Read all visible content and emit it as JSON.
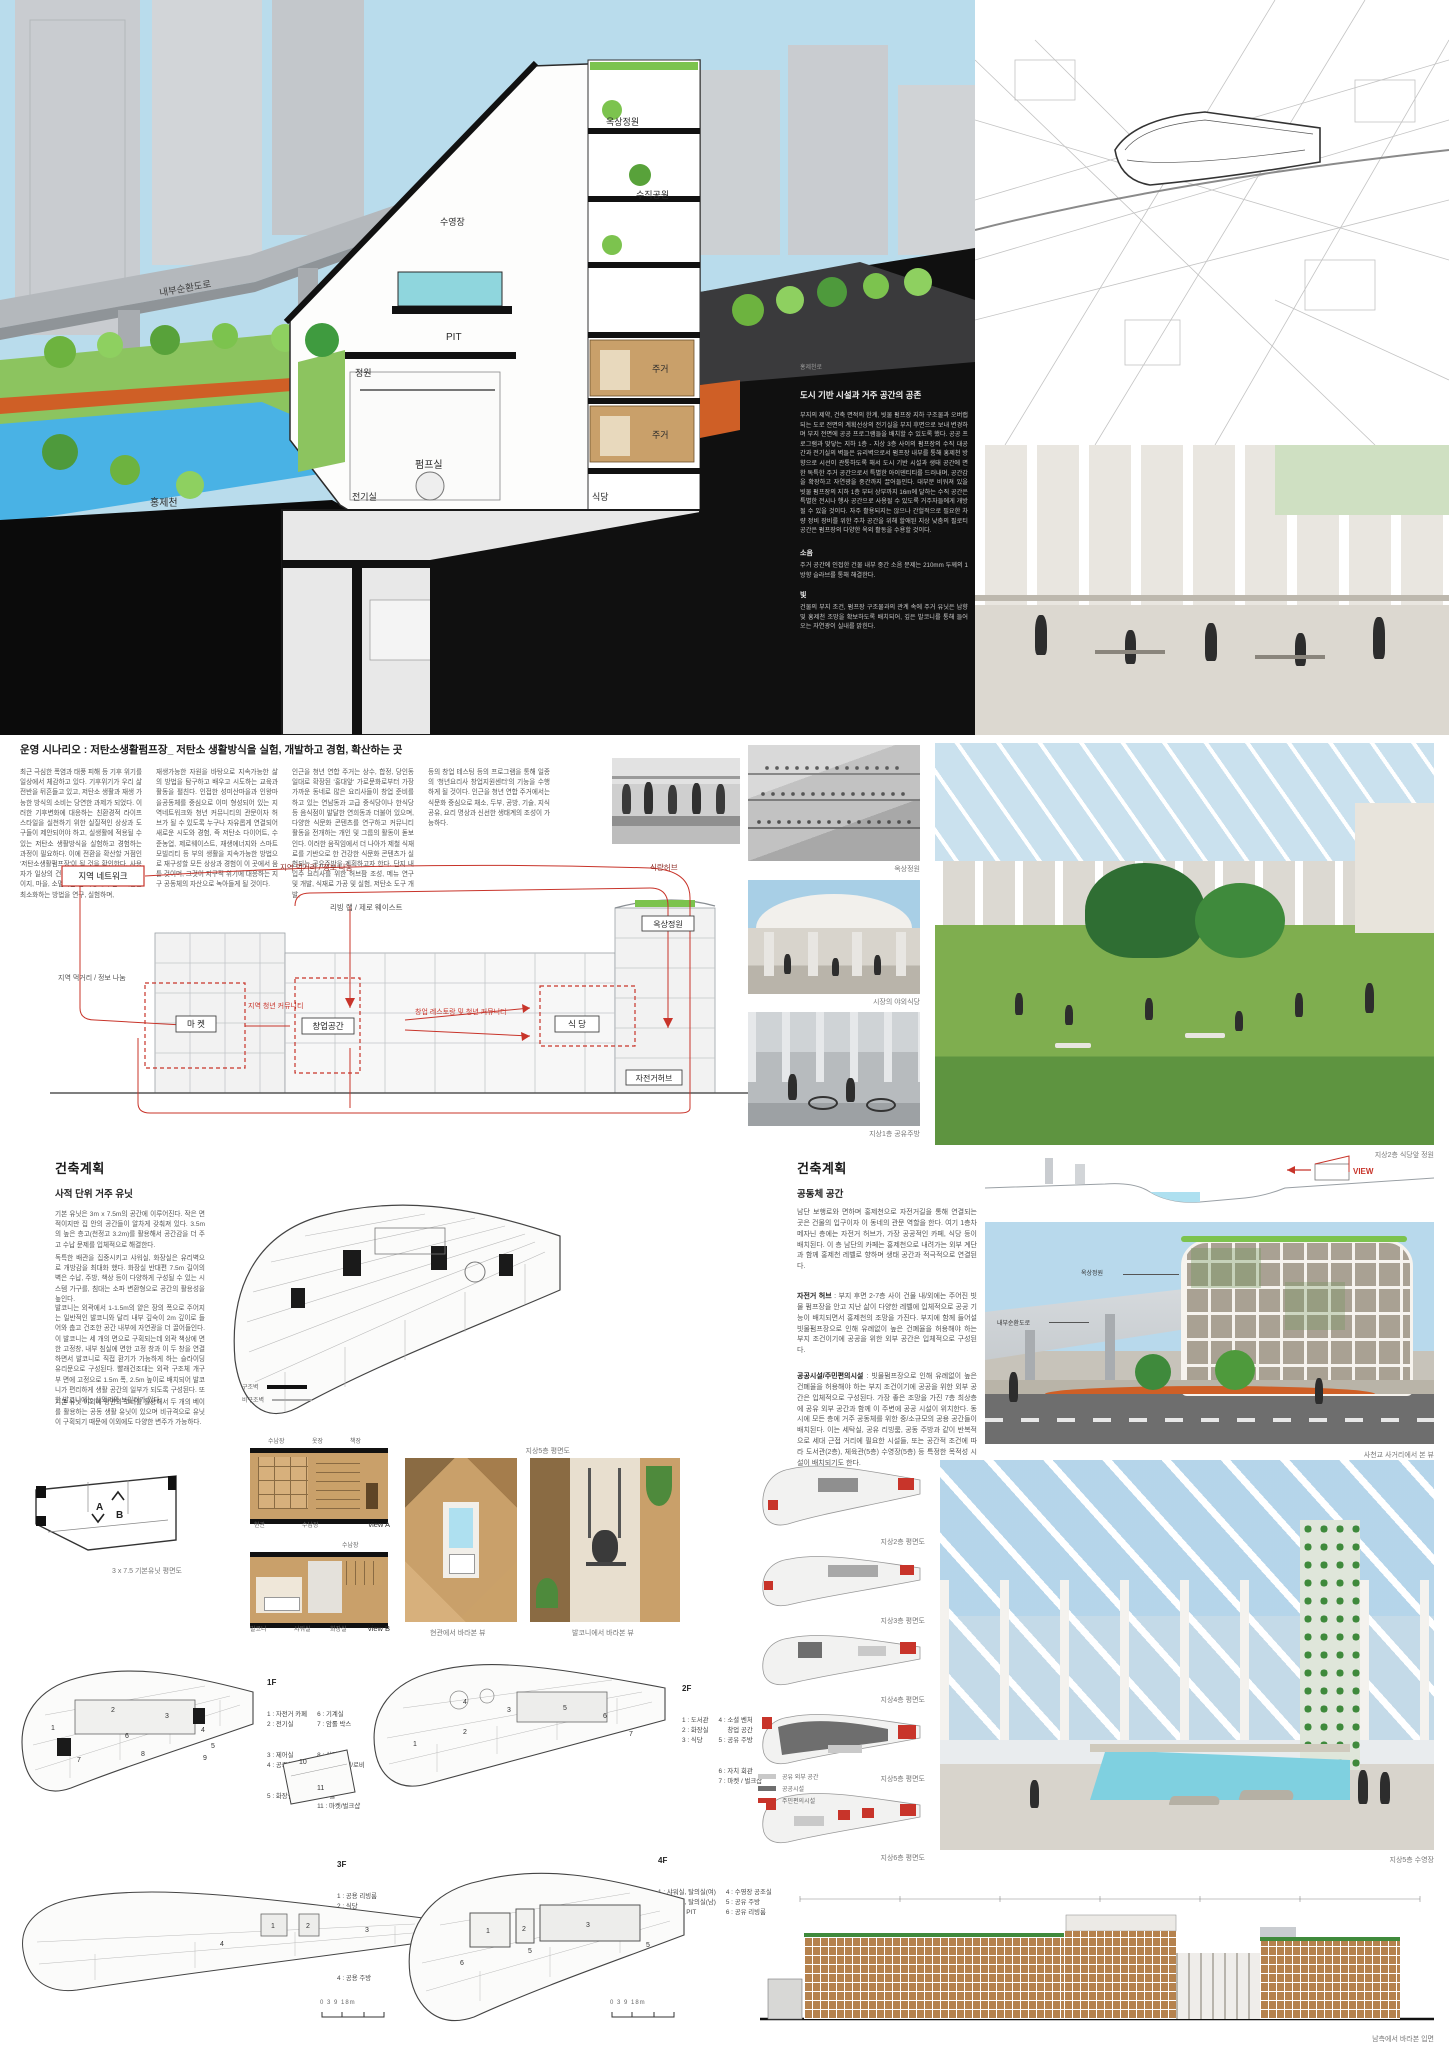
{
  "section": {
    "labels": {
      "road": "내부순환도로",
      "stream": "홍제천",
      "pool": "수영장",
      "roof_garden": "옥상정원",
      "vertical_park": "수직공원",
      "pit": "PIT",
      "garden": "정원",
      "housing_upper": "주거",
      "housing_lower": "주거",
      "pump_room": "펌프실",
      "electrical": "전기실",
      "dining": "식당",
      "street": "홍제천로"
    },
    "side": {
      "heading": "도시 기반 시설과 거주 공간의 공존",
      "body": "부지의 제약, 건축 면적의 한계, 빗물 펌프장 지하 구조물과 오버랩되는 도로 전면의 계획선상의 전기실을 부지 후면으로 보내 변경하며 부지 전면에 공공 프로그램들을 배치할 수 있도록 했다. 공공 프로그램과 맞닿는 지하 1층 - 지상 3층 사이의 펌프장의 수직 대공간과 전기실의 벽들은 유리벽으로서 펌프장 내부를 통해 홍제천 방향으로 시선이 관통하도록 해서 도시 기반 시설과 생태 공간에 면한 독특한 주거 공간으로서 특별한 아이덴티티를 드러내며, 공간감을 확장하고 자연광을 중간까지 끌어들인다. 대부분 비워져 있을 빗물 펌프장의 지하 1층 부터 상부까지 16m에 달하는 수직 공간은 특별한 전시나 행사 공간으로 사용될 수 있도록 거주자들에게 개방될 수 있을 것이다. 자주 활용되지는 않으나 간헐적으로 필요한 차량 정비 장비를 위한 주차 공간을 위해 할애된 지상 낮춤의 필로티 공간은 펌프장의 다양한 옥외 활동을 수용할 것이다.",
      "noise_head": "소음",
      "noise_body": "주거 공간에 인접한 건물 내부 중간 소음 문제는 210mm 두께의 1방향 슬라브를 통해 해결한다.",
      "light_head": "빛",
      "light_body": "건물의 부지 조건, 펌프장 구조물과의 관계 속에 주거 유닛은 남향 및 홍제천 조망을 확보하도록 배치되어, 깊은 발코니를 통해 들어오는 자연광이 실내를 밝힌다."
    }
  },
  "scenario": {
    "title": "운영 시나리오 : 저탄소생활펌프장_ 저탄소 생활방식을 실험, 개발하고 경험, 확산하는 곳",
    "col1": "최근 극심한 폭염과 태풍 피해 등 기후 위기를 일상에서 체감하고 있다. 기후위기가 우리 삶 전반을 뒤흔들고 있고, 저탄소 생활과 재생 가능한 방식의 소비는 당연한 과제가 되었다. 이러한 기후변화에 대응하는 친환경적 라이프스타일을 실천하기 위한 실질적인 상상과 도구들이 제안되어야 하고, 실생활에 적용될 수 있는 저탄소 생활방식을 실험하고 경험하는 과정이 필요하다. 이에 전환을 확산할 거점인 '저탄소생활펌프장'이 될 것을 확인한다. 사용자가 일상의 건물 직접 생산할 수 있고, 스테이지, 마을, 소멸되는 전 과정에서 탄소배출을 최소화하는 방법을 연구, 실험하며,",
    "col2": "재생가능한 자원을 바탕으로 지속가능한 삶의 방법을 탐구하고 배우고 시도하는 교육과 활동을 펼친다. 인접한 성미산마을과 인왕마을공동체를 중심으로 이미 형성되어 있는 지역네트워크와 청년 커뮤니티의 관문이자 허브가 될 수 있도록 누구나 자유롭게 연결되어 새로운 시도와 경험, 즉 저탄소 다이어트, 수준농업, 제로웨이스트, 재생에너지와 스마트 모빌리티 등 부의 생활을 지속가능한 방법으로 재구성할 모든 상상과 경험이 이 곳에서 움틀 것이며, 그것이 지구적 위기에 대응하는 지구 공동체의 자산으로 녹아들게 될 것이다.",
    "col3": "인근을 청년 연합 주거는 상수, 합정, 당인동 일대로 확장된 '홍대앞' 가로문화로부터 가장 가까운 동네로 많은 요리사들이 창업 준비를 하고 있는 연남동과 고급 중식당이나 한식당 등 음식점이 발달한 연희동과 더불어 있으며, 다양한 식문화 콘텐츠를 연구하고 커뮤니티 활동을 전개하는 개인 및 그룹의 활동이 돋보인다. 이러한 움직임에서 더 나아가 제철 식재료를 기반으로 한 건강한 식문화 콘텐츠가 실험되는 공유주방을 계획하고자 한다. 단지 내 입주 요리사를 위한 허브팜 조성, 메뉴 연구 및 개발, 식재료 가공 및 실험, 저탄소 도구 개발,",
    "col4": "등의 창업 테스팅 등의 프로그램을 통해 일종의 '청년요리사 창업지원센터'의 기능을 수행하게 될 것이다. 인근을 청년 연합 주거에서는 식문화 중심으로 채소, 두부, 공방, 기술, 지식 공유, 요리 명상과 신선한 생태계의 조성이 가능하다."
  },
  "flow": {
    "top_label": "지역 먹거리 / 정보 나눔",
    "top_right_label": "식량허브",
    "mid_label": "리빙 랩 / 제로 웨이스트",
    "left_label": "지역 먹거리 / 정보 나눔",
    "network_box": "지역 네트워크",
    "market_box": "마 켓",
    "youth_label": "지역 청년 커뮤니티",
    "startup_box": "창업공간",
    "startup_rest_label": "창업 레스토랑 및\n청년 커뮤니티",
    "dining_box": "식 당",
    "roofgarden_box": "옥상정원",
    "bike_box": "자전거허브"
  },
  "right_photos": {
    "cap1": "옥상정원",
    "cap2": "시장의 야외식당",
    "cap3": "지상1층 공유주방",
    "cap_big": "지상2층 식당앞 정원"
  },
  "arch_left": {
    "heading": "건축계획",
    "subheading": "사적 단위 거주 유닛",
    "p1": "기본 유닛은 3m x 7.5m의 공간에 이루어진다. 작은 면적이지만 집 안의 공간들이 알차게 갖춰져 있다. 3.5m의 높은 층고(천정고 3.2m)를 활용해서 공간감을 더 주고 수납 문제를 입체적으로 해결한다.",
    "p2": "독특한 배관을 집중시키고 샤워실, 화장실은 유리벽으로 개방감을 최대화 했다. 화장실 반대편 7.5m 길이의 벽은 수납, 주방, 책상 등이 다양하게 구성될 수 있는 시스템 가구를, 침대는 소파 변환형으로 공간의 활용성을 높인다.",
    "p3": "발코니는 외곽에서 1-1.5m의 얕은 장의 폭으로 주어지는 일반적인 발코니와 달리 내부 깊숙이 2m 깊이로 들어와 춥고 건조한 공간 내부에 자연광을 더 끌어들인다. 이 발코니는 세 개의 면으로 구획되는데 외곽 책상에 면한 고정창, 내부 침실에 면한 고정 창과 이 두 창을 연결하면서 발코니로 직접 환기가 가능하게 하는 슬라이딩 유리문으로 구성된다. 빨래건조대는 외곽 구조체 개구부 면에 고정으로 1.5m 폭, 2.5m 높이로 배치되어 발코니가 편리하게 생활 공간의 일부가 되도록 구성된다. 또한 발코니에는 실외기와 보일러가 있다.",
    "p4": "기본 유닛 이외에 평면의 코너를 활용해서 두 개의 베이를 활용하는 공동 생활 유닛이 있으며 비규격으로 유닛이 구획되기 때문에 이외에도 다양한 변주가 가능하다.",
    "legend_struct": "구조벽",
    "legend_nonstruct": "비구조벽",
    "plan_caption": "지상5층 평면도"
  },
  "unit_row": {
    "plan_caption": "3 x 7.5 기본유닛 평면도",
    "viewA_top1": "수납장",
    "viewA_top2": "옷장",
    "viewA_top3": "책장",
    "viewA_bot1": "현관",
    "viewA_bot2": "수납장",
    "viewA_label": "view A",
    "viewB_top1": "수납장",
    "viewB_bot1": "발코니",
    "viewB_bot2": "샤워실",
    "viewB_bot3": "화장실",
    "viewB_label": "view B",
    "render1_caption": "현관에서 바라본 뷰",
    "render2_caption": "발코니에서 바라본 뷰",
    "arrowA": "A",
    "arrowB": "B"
  },
  "plans": {
    "f1": {
      "title": "1F",
      "col1": [
        "1 : 자전거 카페",
        "2 : 전기실",
        "3 : 제어실",
        "4 : 공조실",
        "5 : 화장실"
      ],
      "col2": [
        "6 : 기계실",
        "7 : 암롤 박스",
        "8 : 식당",
        "9 : 벤처 마켓/로비",
        "10 : 홀",
        "11 : 마켓/벌크샵"
      ],
      "nums": [
        "1",
        "2",
        "3",
        "4",
        "5",
        "6",
        "7",
        "8",
        "9",
        "10",
        "11"
      ]
    },
    "f2": {
      "title": "2F",
      "col1": [
        "1 : 도서관",
        "2 : 화장실",
        "3 : 식당"
      ],
      "col2": [
        "4 : 소셜 벤처",
        "     창업 공간",
        "5 : 공유 주방",
        "6 : 자치 회관",
        "7 : 마켓 / 벌크샵"
      ],
      "nums": [
        "1",
        "2",
        "3",
        "4",
        "5",
        "6",
        "7"
      ]
    },
    "f3": {
      "title": "3F",
      "items": [
        "1 : 공용 리빙룸",
        "2 : 식당",
        "3 : 소셜 벤처",
        "     창업 공간",
        "4 : 공용 주방"
      ],
      "nums": [
        "1",
        "2",
        "3",
        "4"
      ]
    },
    "f4": {
      "title": "4F",
      "col1": [
        "1 : 샤워실, 탈의실(여)",
        "2 : 샤워실, 탈의실(남)",
        "3 : 수영장 PIT"
      ],
      "col2": [
        "4 : 수영장 공조실",
        "5 : 공유 주방",
        "6 : 공유 리빙룸"
      ],
      "nums": [
        "1",
        "2",
        "3",
        "5",
        "5",
        "6"
      ]
    },
    "scale_bar": "0  3     9        18m"
  },
  "arch_right": {
    "heading": "건축계획",
    "subheading": "공동체 공간",
    "p1": "남단 보행로와 면하며 홍제천으로 자전거길을 통해 연결되는 곳은 건물의 입구이자 이 동네의 관문 역할을 한다. 여기 1층차 메자닌 층에는 자전거 허브가, 가장 공공적인 카페, 식당 등이 배치된다. 이 층 남단의 카페는 홍제천으로 내려가는 외부 계단과 함께 홍제천 레벨로 향하며 생태 공간과 적극적으로 연결된다.",
    "p2_lead": "자전거 허브",
    "p2": " : 부지 후면 2-7층 사이 건물 내/외에는 주어진 빗물 펌프장을 안고 지난 삶이 다양한 레벨에 입체적으로 공공 기능이 배치되면서 홍제천의 조망을 가진다. 부지에 함께 들어설 빗물펌프장으로 인해 유례없이 높은 건폐율을 허용해야 하는 부지 조건이기에 공공을 위한 외부 공간은 입체적으로 구성된다.",
    "p3_lead": "공공시설/주민편의시설",
    "p3": " : 빗물펌프장으로 인해 유례없이 높은 건폐율을 허용해야 하는 부지 조건이기에 공공을 위한 외부 공간은 입체적으로 구성된다. 가장 좋은 조망을 가진 7층 최상층에 공유 외부 공간과 함께 이 주변에 공공 시설이 위치한다. 동시에 모든 층에 거주 공동체를 위한 중/소규모의 공용 공간들이 배치된다. 이는 세탁실, 공유 리빙룸, 공동 주방과 같이 반복적으로 세대 근접 거리에 필요한 시설들, 또는 공간적 조건에 따라 도서관(2층), 체육관(5층) 수영장(5층) 등 특정한 목적성 시설이 배치되기도 한다.",
    "view_label": "VIEW"
  },
  "mini_plans": {
    "captions": [
      "지상2층 평면도",
      "지상3층 평면도",
      "지상4층 평면도",
      "지상5층 평면도",
      "지상6층 평면도"
    ],
    "legend": [
      {
        "label": "공유 외부 공간",
        "color": "#c9c9c9"
      },
      {
        "label": "공공시설",
        "color": "#6e6e6e"
      },
      {
        "label": "주민편의시설",
        "color": "#c8342a"
      }
    ]
  },
  "renders": {
    "building_caption": "사천교 사거리에서 본 뷰",
    "callout_roof": "옥상정원",
    "callout_road": "내부순환도로",
    "atrium_caption": "지상5층 수영장",
    "elevation_caption": "남측에서 바라본 입면"
  },
  "colors": {
    "sky": "#b9dcec",
    "water": "#49b2e5",
    "leaf": "#6db33f",
    "orange": "#cf5f26",
    "red": "#c8342a",
    "wood": "#c9a06a",
    "dark": "#0b0b0b"
  }
}
